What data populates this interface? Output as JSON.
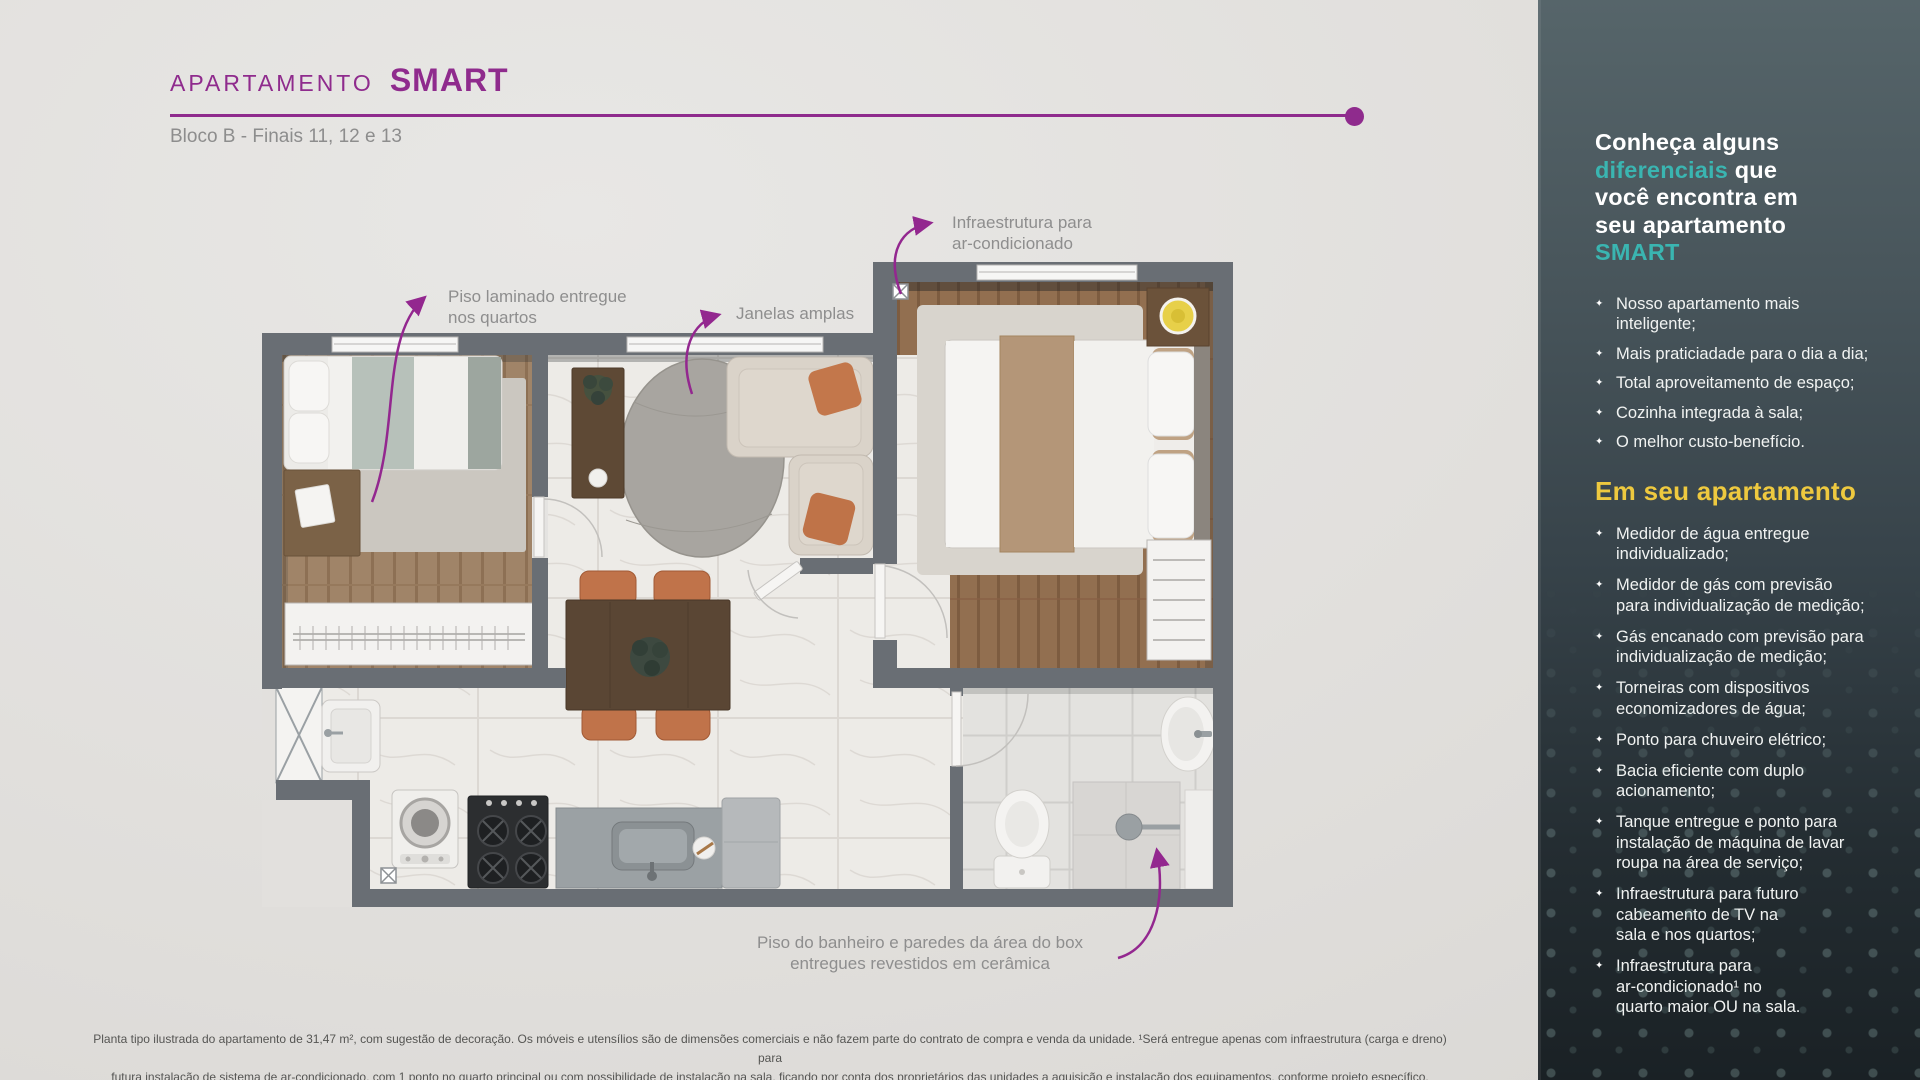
{
  "colors": {
    "accent_purple": "#8f2b8d",
    "accent_teal": "#3ab5b1",
    "accent_yellow": "#eec93f",
    "wall_gray": "#696e74"
  },
  "header": {
    "title_prefix": "APARTAMENTO",
    "title_name": "SMART",
    "subtitle": "Bloco B - Finais 11, 12 e 13"
  },
  "plan": {
    "annotations": {
      "piso_laminado": "Piso laminado entregue\nnos quartos",
      "janelas": "Janelas amplas",
      "infra_ac": "Infraestrutura para\nar-condicionado",
      "piso_banheiro": "Piso do banheiro e paredes da área do box\nentregues revestidos em cerâmica"
    }
  },
  "sidebar": {
    "bullet": "✦",
    "heading_parts": [
      {
        "text": "Conheça alguns\n"
      },
      {
        "text": "diferenciais",
        "accent": true
      },
      {
        "text": " que\nvocê encontra em\nseu apartamento\n"
      },
      {
        "text": "SMART",
        "accent": true
      }
    ],
    "intro_items": [
      "Nosso apartamento mais\ninteligente;",
      "Mais praticiadade para o dia a dia;",
      "Total aproveitamento de espaço;",
      "Cozinha integrada à sala;",
      "O melhor custo-benefício."
    ],
    "section_title": "Em seu apartamento",
    "apartment_items": [
      "Medidor de água entregue\nindividualizado;",
      "Medidor de gás com previsão\npara individualização de medição;",
      "Gás encanado com previsão para\nindividualização de medição;",
      "Torneiras com dispositivos\neconomizadores de água;",
      "Ponto para chuveiro elétrico;",
      "Bacia eficiente com duplo\nacionamento;",
      "Tanque entregue e ponto para\ninstalação de máquina de lavar\nroupa na área de serviço;",
      "Infraestrutura para futuro\ncabeamento de TV na\nsala e nos quartos;",
      "Infraestrutura para\nar-condicionado¹ no\nquarto maior OU na sala."
    ]
  },
  "disclaimer": {
    "line1": "Planta tipo ilustrada do apartamento de 31,47 m², com sugestão de decoração. Os móveis e utensílios são de dimensões comerciais e não fazem parte do contrato de compra e venda da unidade. ¹Será entregue apenas com infraestrutura (carga e dreno) para",
    "line2": "futura instalação de sistema de ar-condicionado, com 1 ponto no quarto principal ou com possibilidade de instalação na sala, ficando por conta dos proprietários das unidades a aquisição e instalação dos equipamentos, conforme projeto específico."
  }
}
